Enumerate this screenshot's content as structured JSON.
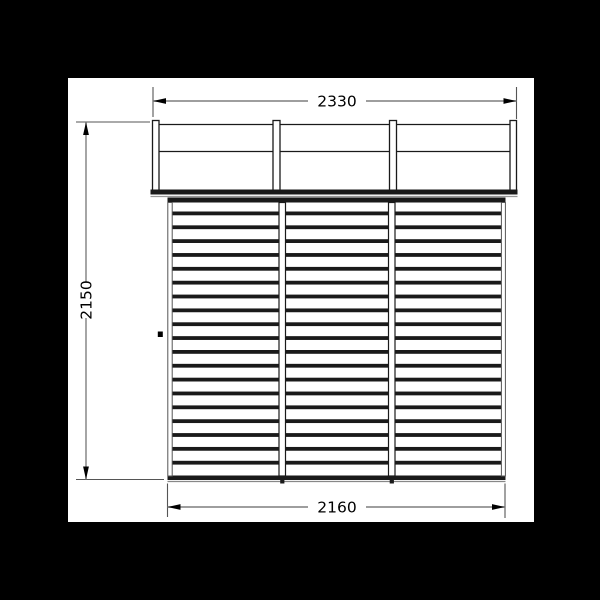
{
  "drawing": {
    "type": "technical_elevation",
    "subject": "garden-building-rear-elevation",
    "dimensions": {
      "top_width": {
        "value": "2330",
        "orientation": "horizontal",
        "position": "top"
      },
      "side_height": {
        "value": "2150",
        "orientation": "vertical",
        "position": "left"
      },
      "bottom_width": {
        "value": "2160",
        "orientation": "horizontal",
        "position": "bottom"
      }
    },
    "structure": {
      "panel_count": 3,
      "slat_separators": 19,
      "post_count": 4,
      "batten_count": 2
    },
    "colors": {
      "background": "#000000",
      "paper": "#ffffff",
      "line": "#1a1a1a",
      "trim_line": "#555555",
      "dimension_line": "#7f7f7f",
      "extension_line": "#555555",
      "under_band_line": "#999999",
      "text": "#000000"
    }
  }
}
